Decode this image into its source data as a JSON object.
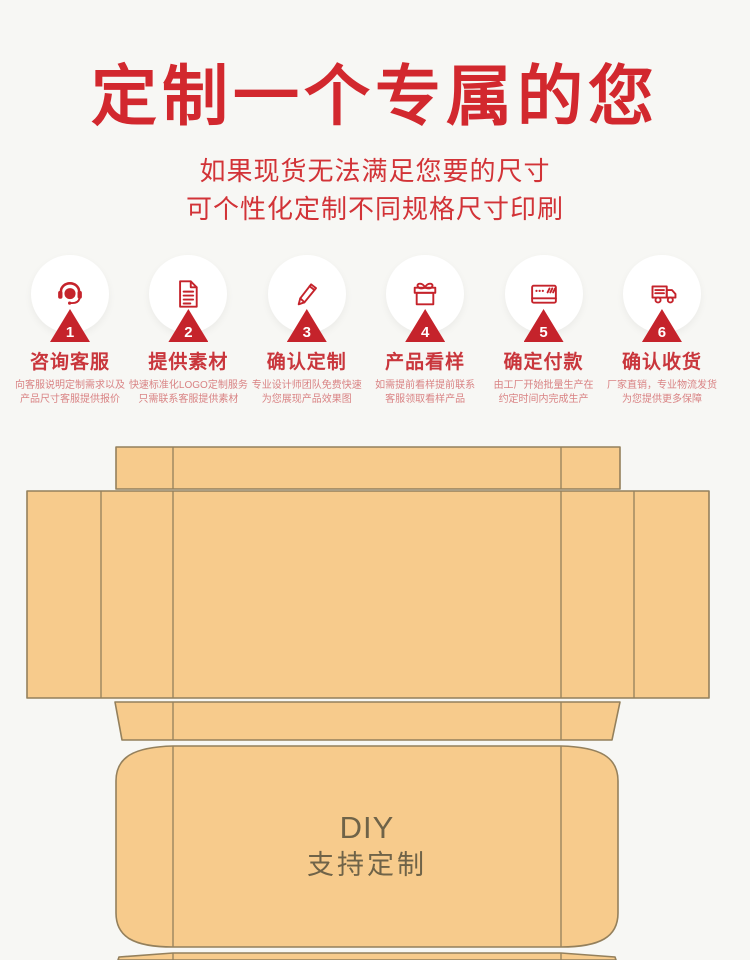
{
  "theme": {
    "page_bg": "#f7f7f4",
    "accent": "#d2282e",
    "accent_sub": "#d23337",
    "accent_icon": "#c5232b",
    "step_title": "#c9363c",
    "desc_color": "#d98384",
    "circle_bg": "#ffffff",
    "box_fill": "#f7cb8c",
    "box_stroke": "#94805c",
    "box_text": "#6f6348"
  },
  "header": {
    "title": "定制一个专属的您",
    "subtitle_line1": "如果现货无法满足您要的尺寸",
    "subtitle_line2": "可个性化定制不同规格尺寸印刷"
  },
  "steps": [
    {
      "num": "1",
      "icon": "headset-agent-icon",
      "title": "咨询客服",
      "desc1": "向客服说明定制需求以及",
      "desc2": "产品尺寸客服提供报价"
    },
    {
      "num": "2",
      "icon": "document-icon",
      "title": "提供素材",
      "desc1": "快速标准化LOGO定制服务",
      "desc2": "只需联系客服提供素材"
    },
    {
      "num": "3",
      "icon": "pencil-icon",
      "title": "确认定制",
      "desc1": "专业设计师团队免费快速",
      "desc2": "为您展现产品效果图"
    },
    {
      "num": "4",
      "icon": "gift-icon",
      "title": "产品看样",
      "desc1": "如需提前看样提前联系",
      "desc2": "客服领取看样产品"
    },
    {
      "num": "5",
      "icon": "credit-card-icon",
      "title": "确定付款",
      "desc1": "由工厂开始批量生产在",
      "desc2": "约定时间内完成生产"
    },
    {
      "num": "6",
      "icon": "truck-icon",
      "title": "确认收货",
      "desc1": "厂家直销，专业物流发货",
      "desc2": "为您提供更多保障"
    }
  ],
  "diagram": {
    "label_line1": "DIY",
    "label_line2": "支持定制"
  }
}
